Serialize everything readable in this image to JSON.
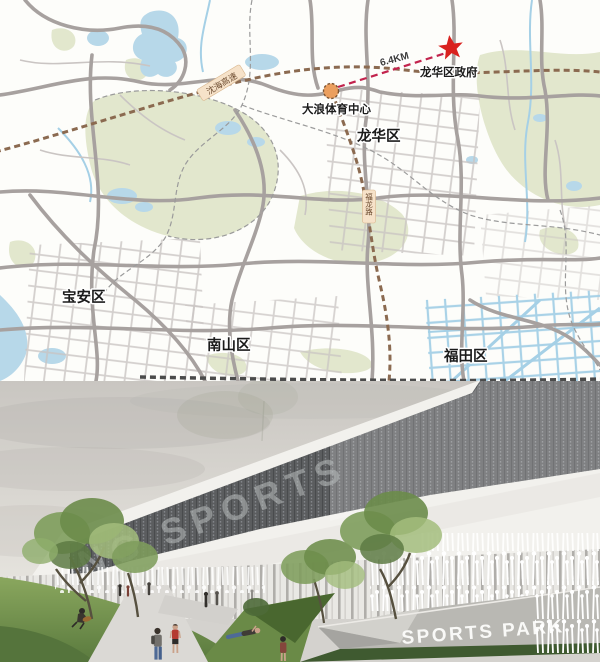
{
  "map": {
    "labels": {
      "baoan": "宝安区",
      "nanshan": "南山区",
      "futian": "福田区",
      "longhua": "龙华区",
      "origin": "大浪体育中心",
      "destination": "龙华区政府",
      "distance": "6.4KM",
      "expressway": "沈海高速",
      "road": "福龙路"
    },
    "colors": {
      "water": "#b7d8e9",
      "greenery": "#e2e7cd",
      "road_major": "#a7a19f",
      "road_minor": "#cac5c3",
      "road_blue": "#a5d0e6",
      "highway": "#8b6a50",
      "route": "#c2234d",
      "star": "#d9221f",
      "origin_marker": "#eb9f5e",
      "label": "#1b1b1b"
    }
  },
  "render": {
    "facade_text": "NG SPORTS",
    "sign_text": "SPORTS PARK",
    "colors": {
      "sky_top": "#c9c6c1",
      "sky_bottom": "#f1efe9",
      "concrete": "#f2f1ed",
      "mesh": "#5b5d5f",
      "lawn": "#7d9c55",
      "lawn_dark": "#55743c",
      "path": "#dbd9d5",
      "sign_panel": "#b9b8b3",
      "tree": "#7e9d5c",
      "reeds": "#ffffff",
      "shirt_red": "#b53a30",
      "jeans_blue": "#4e6a96"
    }
  }
}
